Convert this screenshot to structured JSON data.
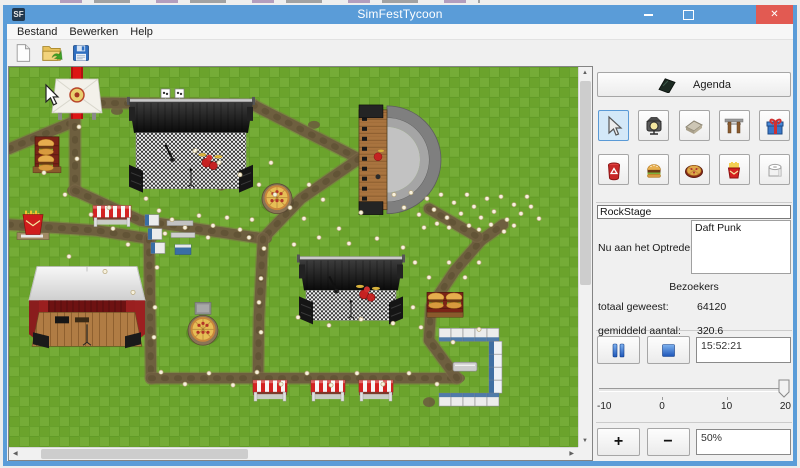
{
  "window": {
    "title": "SimFestTycoon",
    "icon_text": "SF"
  },
  "menu": {
    "items": [
      "Bestand",
      "Bewerken",
      "Help"
    ]
  },
  "toolbar": {
    "icons": [
      "new-file",
      "open-file",
      "save-file"
    ]
  },
  "panel": {
    "agenda_label": "Agenda",
    "tools": [
      {
        "name": "select",
        "selected": true
      },
      {
        "name": "light"
      },
      {
        "name": "path"
      },
      {
        "name": "gate"
      },
      {
        "name": "gift"
      },
      {
        "name": "trash"
      },
      {
        "name": "burger"
      },
      {
        "name": "pizza"
      },
      {
        "name": "fries"
      },
      {
        "name": "toilet"
      }
    ],
    "stage_name": "RockStage",
    "now_playing_label": "Nu aan het Optreden:",
    "now_playing_value": "Daft Punk",
    "visitors_header": "Bezoekers",
    "total_label": "totaal geweest:",
    "total_value": "64120",
    "average_label": "gemiddeld aantal:",
    "average_value": "320.6",
    "time": "15:52:21",
    "slider": {
      "ticks": [
        "-10",
        "0",
        "10",
        "20"
      ],
      "value": 20
    },
    "zoom_value": "50%",
    "plus_label": "+",
    "minus_label": "−"
  },
  "colors": {
    "titlebar": "#5a9cd8",
    "close_button": "#e25a52",
    "grass": "#6ba32c",
    "path": "#6e5d3f",
    "tool_selected": "#d3e8f8"
  },
  "map": {
    "cursor": {
      "x": 37,
      "y": 18
    },
    "paths": [
      {
        "pts": [
          [
            0,
            82
          ],
          [
            62,
            56
          ]
        ]
      },
      {
        "pts": [
          [
            66,
            46
          ],
          [
            66,
            124
          ]
        ]
      },
      {
        "pts": [
          [
            66,
            124
          ],
          [
            132,
            154
          ],
          [
            254,
            172
          ]
        ]
      },
      {
        "pts": [
          [
            92,
            36
          ],
          [
            244,
            38
          ]
        ]
      },
      {
        "pts": [
          [
            244,
            38
          ],
          [
            350,
            92
          ]
        ]
      },
      {
        "pts": [
          [
            350,
            92
          ],
          [
            292,
            132
          ],
          [
            254,
            172
          ]
        ]
      },
      {
        "pts": [
          [
            254,
            172
          ],
          [
            250,
            250
          ],
          [
            249,
            312
          ]
        ]
      },
      {
        "pts": [
          [
            0,
            158
          ],
          [
            88,
            164
          ],
          [
            140,
            172
          ]
        ]
      },
      {
        "pts": [
          [
            140,
            172
          ],
          [
            142,
            312
          ]
        ]
      },
      {
        "pts": [
          [
            142,
            312
          ],
          [
            448,
            312
          ]
        ]
      },
      {
        "pts": [
          [
            448,
            312
          ],
          [
            420,
            274
          ],
          [
            422,
            240
          ],
          [
            446,
            204
          ],
          [
            472,
            174
          ],
          [
            494,
            158
          ]
        ]
      },
      {
        "pts": [
          [
            420,
            142
          ],
          [
            468,
            170
          ]
        ]
      }
    ],
    "patches": [
      [
        66,
        124,
        8,
        6
      ],
      [
        254,
        172,
        9,
        6
      ],
      [
        141,
        172,
        7,
        5
      ],
      [
        250,
        312,
        8,
        5
      ],
      [
        448,
        312,
        8,
        5
      ],
      [
        108,
        44,
        6,
        4
      ],
      [
        305,
        58,
        6,
        4
      ],
      [
        345,
        244,
        6,
        4
      ],
      [
        420,
        336,
        6,
        5
      ],
      [
        63,
        58,
        5,
        4
      ],
      [
        470,
        175,
        7,
        5
      ],
      [
        212,
        120,
        5,
        4
      ]
    ],
    "objects": [
      {
        "type": "carpet",
        "name": "entrance-carpet",
        "x": 62,
        "y": 0
      },
      {
        "type": "tent",
        "name": "entrance-tent",
        "x": 43,
        "y": 12
      },
      {
        "type": "flags",
        "name": "stage-banners",
        "x": 152,
        "y": 22
      },
      {
        "type": "checkerstage",
        "name": "rock-stage",
        "x": 118,
        "y": 26,
        "w": 128,
        "h": 104
      },
      {
        "type": "amphitheater",
        "name": "amphitheater-stage",
        "x": 342,
        "y": 38
      },
      {
        "type": "checkerstage",
        "name": "south-stage",
        "x": 288,
        "y": 184,
        "w": 108,
        "h": 78
      },
      {
        "type": "barn",
        "name": "barn-stage",
        "x": 20,
        "y": 200
      },
      {
        "type": "burgers",
        "name": "burger-stand",
        "x": 24,
        "y": 70,
        "vert": true
      },
      {
        "type": "burgers",
        "name": "burger-stand",
        "x": 418,
        "y": 220
      },
      {
        "type": "fries",
        "name": "fries-stand",
        "x": 6,
        "y": 138
      },
      {
        "type": "stand",
        "name": "market-stall",
        "x": 84,
        "y": 139,
        "w": 38
      },
      {
        "type": "fence",
        "name": "fence-stalls",
        "x": 136,
        "y": 148
      },
      {
        "type": "pizza",
        "name": "pizza-stand",
        "x": 248,
        "y": 104
      },
      {
        "type": "pizza",
        "name": "pizza-stand",
        "x": 174,
        "y": 236,
        "pole": true
      },
      {
        "type": "toilets",
        "name": "toilet-block",
        "x": 428,
        "y": 262
      },
      {
        "type": "bench",
        "name": "bench",
        "x": 444,
        "y": 296
      },
      {
        "type": "stand",
        "name": "market-stall",
        "x": 244,
        "y": 314,
        "w": 34
      },
      {
        "type": "stand",
        "name": "market-stall",
        "x": 302,
        "y": 314,
        "w": 34
      },
      {
        "type": "stand",
        "name": "market-stall",
        "x": 350,
        "y": 314,
        "w": 34
      }
    ],
    "people": [
      [
        137,
        132
      ],
      [
        150,
        144
      ],
      [
        163,
        153
      ],
      [
        176,
        161
      ],
      [
        190,
        149
      ],
      [
        204,
        159
      ],
      [
        218,
        151
      ],
      [
        231,
        163
      ],
      [
        243,
        153
      ],
      [
        156,
        167
      ],
      [
        199,
        171
      ],
      [
        240,
        171
      ],
      [
        186,
        84
      ],
      [
        210,
        96
      ],
      [
        231,
        108
      ],
      [
        250,
        118
      ],
      [
        266,
        128
      ],
      [
        281,
        141
      ],
      [
        295,
        152
      ],
      [
        262,
        96
      ],
      [
        300,
        118
      ],
      [
        314,
        133
      ],
      [
        385,
        128
      ],
      [
        395,
        141
      ],
      [
        402,
        126
      ],
      [
        410,
        148
      ],
      [
        418,
        132
      ],
      [
        425,
        143
      ],
      [
        432,
        128
      ],
      [
        438,
        151
      ],
      [
        445,
        136
      ],
      [
        452,
        147
      ],
      [
        458,
        128
      ],
      [
        465,
        140
      ],
      [
        472,
        151
      ],
      [
        478,
        132
      ],
      [
        485,
        145
      ],
      [
        492,
        130
      ],
      [
        498,
        153
      ],
      [
        505,
        138
      ],
      [
        512,
        147
      ],
      [
        518,
        130
      ],
      [
        460,
        159
      ],
      [
        470,
        163
      ],
      [
        482,
        158
      ],
      [
        495,
        165
      ],
      [
        440,
        161
      ],
      [
        428,
        157
      ],
      [
        415,
        161
      ],
      [
        505,
        159
      ],
      [
        522,
        140
      ],
      [
        530,
        152
      ],
      [
        152,
        306
      ],
      [
        176,
        318
      ],
      [
        200,
        307
      ],
      [
        224,
        319
      ],
      [
        248,
        306
      ],
      [
        272,
        318
      ],
      [
        298,
        307
      ],
      [
        322,
        319
      ],
      [
        348,
        307
      ],
      [
        374,
        318
      ],
      [
        400,
        307
      ],
      [
        428,
        318
      ],
      [
        285,
        178
      ],
      [
        310,
        171
      ],
      [
        340,
        177
      ],
      [
        368,
        172
      ],
      [
        394,
        181
      ],
      [
        289,
        251
      ],
      [
        320,
        259
      ],
      [
        352,
        253
      ],
      [
        384,
        257
      ],
      [
        404,
        241
      ],
      [
        35,
        106
      ],
      [
        56,
        128
      ],
      [
        82,
        148
      ],
      [
        104,
        162
      ],
      [
        119,
        178
      ],
      [
        60,
        190
      ],
      [
        96,
        205
      ],
      [
        124,
        226
      ],
      [
        406,
        196
      ],
      [
        420,
        211
      ],
      [
        440,
        196
      ],
      [
        456,
        211
      ],
      [
        470,
        196
      ],
      [
        412,
        261
      ],
      [
        444,
        276
      ],
      [
        470,
        263
      ],
      [
        70,
        60
      ],
      [
        68,
        92
      ],
      [
        100,
        141
      ],
      [
        255,
        182
      ],
      [
        252,
        212
      ],
      [
        250,
        236
      ],
      [
        252,
        266
      ],
      [
        148,
        201
      ],
      [
        146,
        241
      ],
      [
        145,
        271
      ],
      [
        330,
        162
      ],
      [
        352,
        146
      ]
    ]
  }
}
